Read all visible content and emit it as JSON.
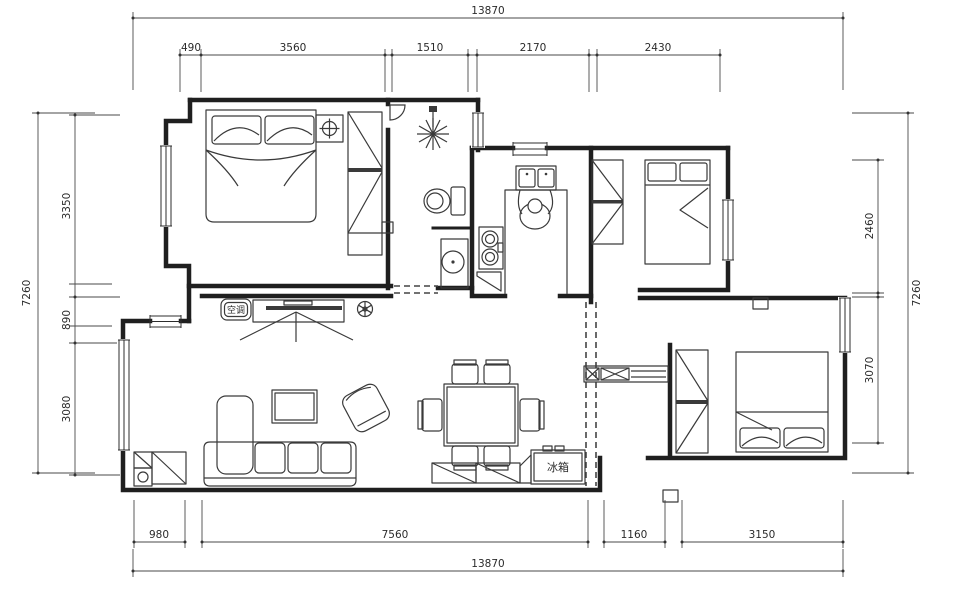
{
  "drawing": {
    "type": "apartment-floor-plan",
    "labels": {
      "air_conditioner": "空调",
      "fridge": "冰箱"
    },
    "dimensions": {
      "top_total": "13870",
      "top_segments": [
        "490",
        "3560",
        "1510",
        "2170",
        "2430"
      ],
      "left_total": "7260",
      "left_segments": [
        "3350",
        "890",
        "3080"
      ],
      "right_total": "7260",
      "right_segments": [
        "2460",
        "3070"
      ],
      "bottom_total": "13870",
      "bottom_segments": [
        "980",
        "7560",
        "1160",
        "3150"
      ]
    }
  }
}
